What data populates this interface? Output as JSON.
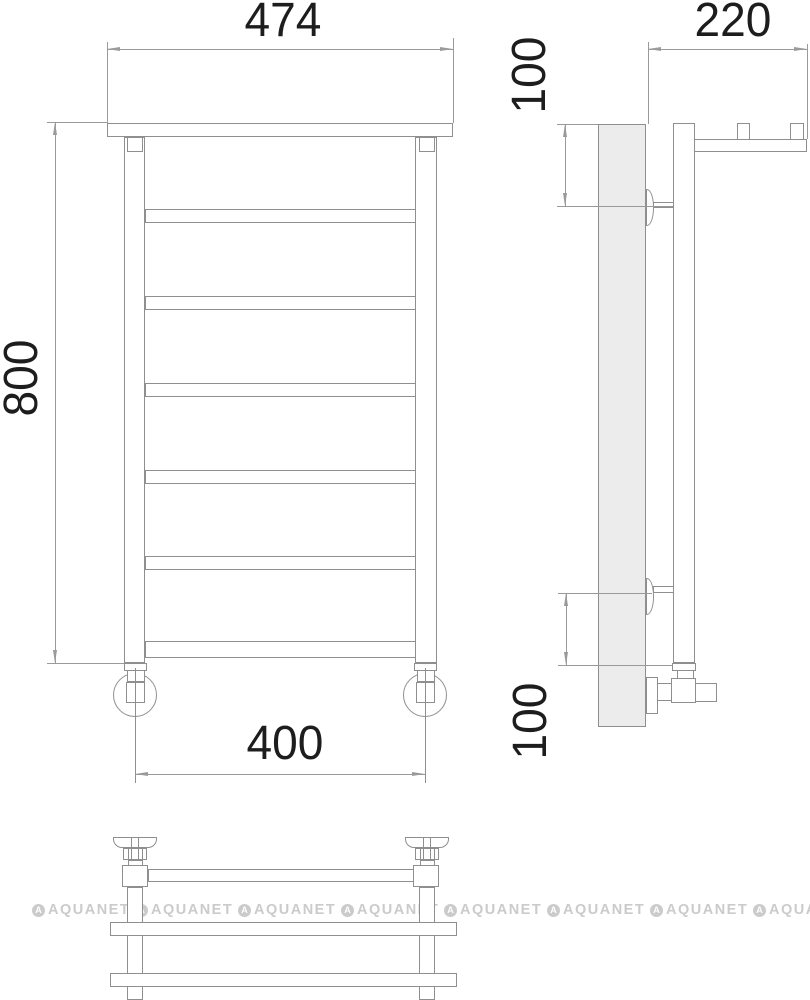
{
  "dimensions": {
    "front_width": "474",
    "front_height": "800",
    "front_connection_spacing": "400",
    "side_depth": "220",
    "side_top_bracket_offset": "100",
    "side_bottom_bracket_offset": "100"
  },
  "watermark": {
    "text": "AQUANET",
    "logo_letter": "A"
  }
}
